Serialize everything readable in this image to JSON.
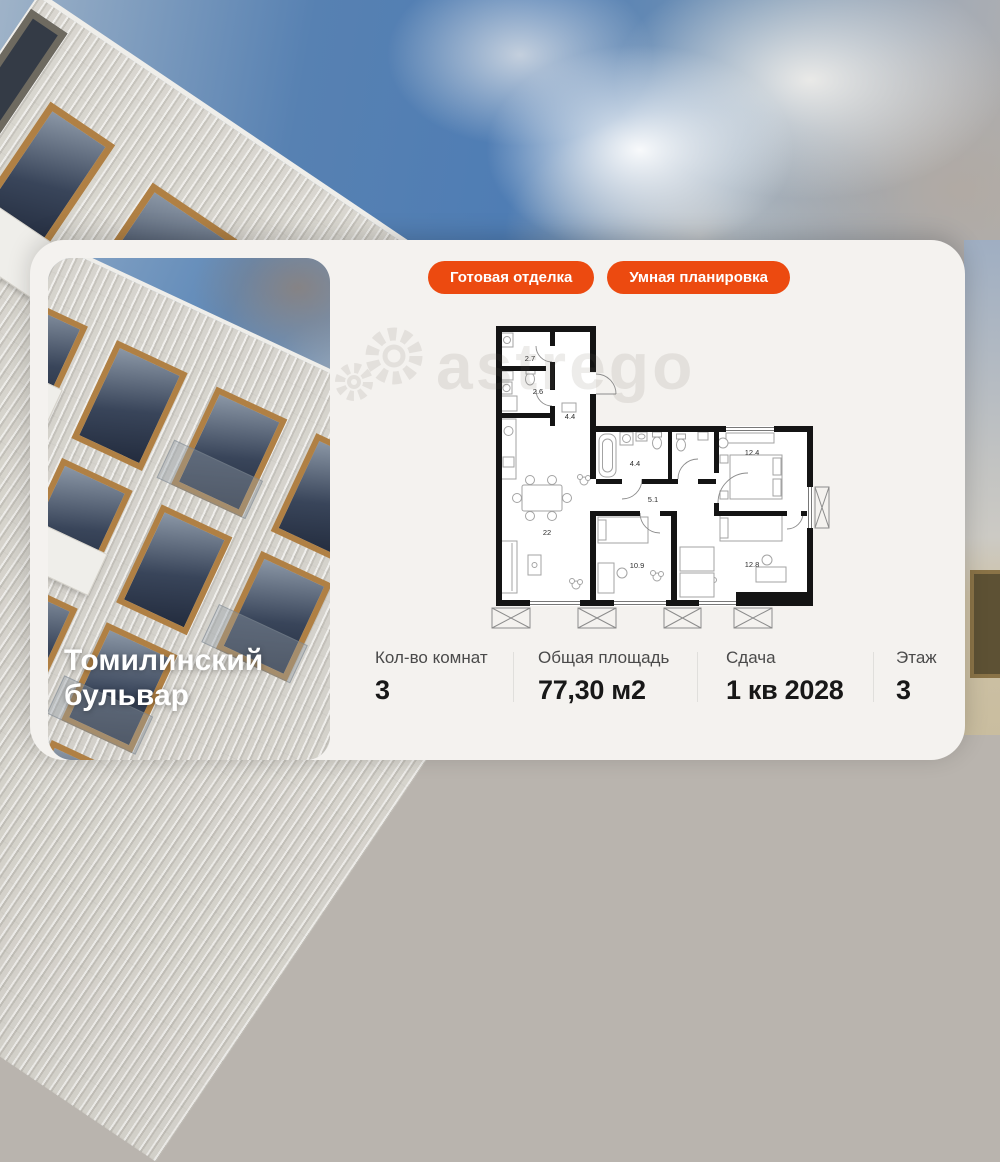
{
  "colors": {
    "accent": "#EC4A10",
    "card_bg": "#F4F2EF",
    "sky_blue": "#4F7DB4",
    "wall": "#141414"
  },
  "badges": [
    {
      "label": "Готовая отделка"
    },
    {
      "label": "Умная планировка"
    }
  ],
  "listing": {
    "title": "Томилинский бульвар"
  },
  "watermark": {
    "text": "astrego",
    "icon": "gear-icon"
  },
  "floorplan": {
    "rooms": [
      {
        "name": "storage",
        "area": "2.7"
      },
      {
        "name": "bathroom-small",
        "area": "2.6"
      },
      {
        "name": "hallway",
        "area": "4.4"
      },
      {
        "name": "bathroom",
        "area": "4.4"
      },
      {
        "name": "corridor",
        "area": "5.1"
      },
      {
        "name": "bedroom-1",
        "area": "12.4"
      },
      {
        "name": "kitchen-living",
        "area": "22"
      },
      {
        "name": "bedroom-2",
        "area": "10.9"
      },
      {
        "name": "bedroom-3",
        "area": "12.8"
      }
    ]
  },
  "stats": [
    {
      "label": "Кол-во комнат",
      "value": "3"
    },
    {
      "label": "Общая площадь",
      "value": "77,30 м2"
    },
    {
      "label": "Сдача",
      "value": "1 кв 2028"
    },
    {
      "label": "Этаж",
      "value": "3"
    }
  ]
}
